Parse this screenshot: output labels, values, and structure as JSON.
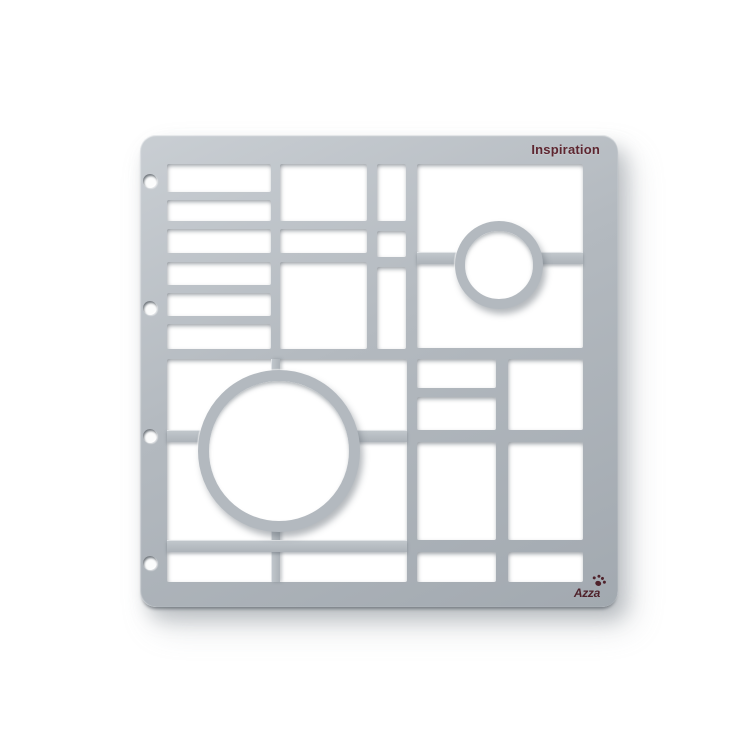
{
  "texts": {
    "title": "Inspiration",
    "brand": "Azza"
  },
  "colors": {
    "background": "#ffffff",
    "plate": "#b3b9bf",
    "plate_light": "#c9ced3",
    "plate_dark": "#a2a9b0",
    "cutout": "#ffffff",
    "title_text": "#5e2630",
    "brand_text": "#4f222b"
  },
  "stencil": {
    "plate": {
      "x": 140,
      "y": 135,
      "w": 478,
      "h": 472,
      "radius": 16
    },
    "holes": {
      "cx": 150,
      "r": 7,
      "cys": [
        181,
        308,
        436,
        563
      ]
    },
    "cutouts": [
      {
        "x": 167,
        "y": 164,
        "w": 104,
        "h": 28
      },
      {
        "x": 167,
        "y": 200,
        "w": 104,
        "h": 21
      },
      {
        "x": 167,
        "y": 229,
        "w": 104,
        "h": 24
      },
      {
        "x": 167,
        "y": 262,
        "w": 104,
        "h": 23
      },
      {
        "x": 167,
        "y": 293,
        "w": 104,
        "h": 23
      },
      {
        "x": 167,
        "y": 324,
        "w": 104,
        "h": 25
      },
      {
        "x": 280,
        "y": 164,
        "w": 87,
        "h": 57
      },
      {
        "x": 280,
        "y": 229,
        "w": 87,
        "h": 24
      },
      {
        "x": 280,
        "y": 262,
        "w": 87,
        "h": 87
      },
      {
        "x": 377,
        "y": 164,
        "w": 29,
        "h": 57
      },
      {
        "x": 377,
        "y": 231,
        "w": 29,
        "h": 26
      },
      {
        "x": 377,
        "y": 267,
        "w": 29,
        "h": 82
      },
      {
        "x": 417,
        "y": 164,
        "w": 166,
        "h": 184
      },
      {
        "x": 167,
        "y": 359,
        "w": 240,
        "h": 223
      },
      {
        "x": 417,
        "y": 359,
        "w": 79,
        "h": 29
      },
      {
        "x": 417,
        "y": 397,
        "w": 79,
        "h": 33
      },
      {
        "x": 508,
        "y": 359,
        "w": 75,
        "h": 71
      },
      {
        "x": 417,
        "y": 442,
        "w": 79,
        "h": 98
      },
      {
        "x": 508,
        "y": 442,
        "w": 75,
        "h": 98
      },
      {
        "x": 417,
        "y": 552,
        "w": 79,
        "h": 30
      },
      {
        "x": 508,
        "y": 552,
        "w": 75,
        "h": 30
      }
    ],
    "bars": [
      {
        "x": 417,
        "y": 252,
        "w": 45,
        "h": 12,
        "dir": "h"
      },
      {
        "x": 534,
        "y": 252,
        "w": 49,
        "h": 12,
        "dir": "h"
      },
      {
        "x": 271,
        "y": 359,
        "w": 9,
        "h": 18,
        "dir": "v"
      },
      {
        "x": 271,
        "y": 526,
        "w": 9,
        "h": 56,
        "dir": "v"
      },
      {
        "x": 167,
        "y": 430,
        "w": 36,
        "h": 12,
        "dir": "h"
      },
      {
        "x": 355,
        "y": 430,
        "w": 52,
        "h": 12,
        "dir": "h"
      },
      {
        "x": 167,
        "y": 540,
        "w": 240,
        "h": 12,
        "dir": "h"
      }
    ],
    "rings": [
      {
        "cx": 499,
        "cy": 265,
        "r_outer": 44,
        "ring": 10
      },
      {
        "cx": 279,
        "cy": 451,
        "r_outer": 81,
        "ring": 11
      }
    ]
  }
}
